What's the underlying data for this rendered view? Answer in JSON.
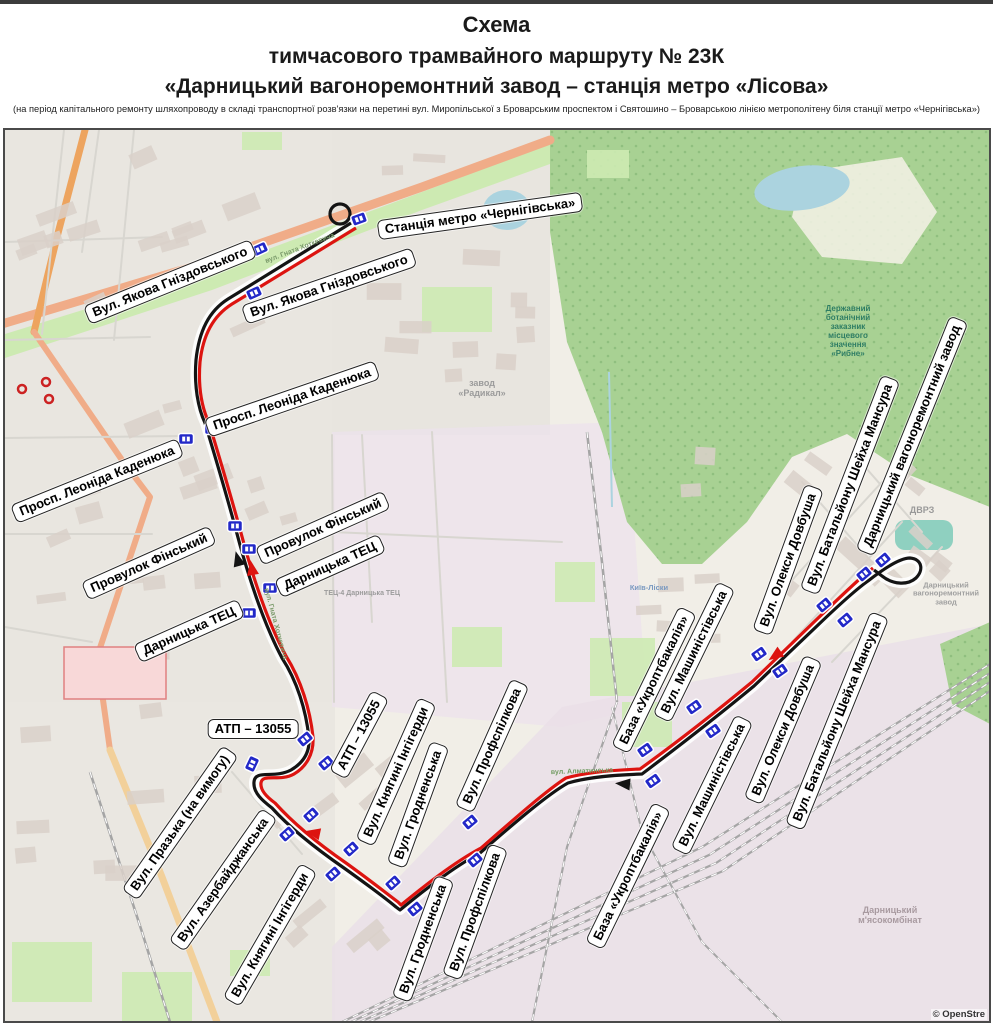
{
  "header": {
    "title1": "Схема",
    "title2": "тимчасового трамвайного маршруту  № 23К",
    "title3": "«Дарницький вагоноремонтний завод – станція метро «Лісова»",
    "note": "(на період капітального ремонту шляхопроводу в складі транспортної розв'язки на перетині вул. Миропільської з Броварським проспектом і Святошино – Броварською лінією метрополітену біля станції метро «Чернігівська»)"
  },
  "map": {
    "colors": {
      "map_bg": "#f1eee7",
      "urban": "#e9e6e0",
      "industrial": "#ece2ec",
      "forest": "#a8d193",
      "forest_dot": "#8fbf7f",
      "park": "#cdeab2",
      "water": "#abd3df",
      "pond_teal": "#8fd0c0",
      "road_salmon": "#f0ac88",
      "road_orange": "#eda45f",
      "road_yellow": "#f2d09a",
      "street": "#d8d6d0",
      "rail": "#a5a5a5",
      "building": "#d9d0c9",
      "route_red": "#dd1410",
      "route_black": "#141414",
      "stop_blue": "#2228c8",
      "stop_border": "#ffffff",
      "poi_red": "#cc2222",
      "hospital_fill": "#f8d8d8",
      "hospital_stroke": "#e08080"
    },
    "route": {
      "metro_loop": {
        "cx": 338,
        "cy": 212,
        "r": 10
      },
      "black_path": "M 349,221 C 320,239 272,269 226,297 C 207,309 197,329 194,358 C 192,384 196,406 203,421 C 212,451 224,490 238,543 C 248,579 262,622 280,656 C 295,679 304,708 307,736 C 308,751 301,761 289,768 C 272,777 253,767 252,780 C 251,791 261,799 270,806 C 288,826 316,848 342,866 C 363,881 382,895 394,905 L 398,908 C 420,890 450,866 478,851 C 510,823 546,792 566,781 C 586,775 612,773 640,772 C 665,753 700,727 752,684 L 815,624 C 840,600 856,586 866,579 C 880,568 897,556 908,556 C 920,557 922,568 914,576 C 905,584 890,582 880,574 L 872,568",
      "red_path": "M 354,226 C 324,244 276,274 230,302 C 211,314 201,333 198,360 C 196,385 200,406 207,421 C 216,451 228,490 242,542 C 252,578 266,621 284,654 C 299,678 308,707 311,735 C 312,752 304,765 292,772 C 278,780 260,771 259,781 C 258,789 266,796 273,801 C 291,821 318,843 344,861 C 365,876 384,891 396,900 L 399,903 C 421,885 451,861 479,846 C 511,818 545,788 564,776 C 585,770 612,768 638,767 C 663,749 698,723 750,680 L 812,620 C 837,596 852,582 861,574 L 871,566"
    },
    "arrows": [
      {
        "x": 236,
        "y": 558,
        "angle": -105,
        "color": "black"
      },
      {
        "x": 250,
        "y": 567,
        "angle": -100,
        "color": "red"
      },
      {
        "x": 312,
        "y": 831,
        "angle": 192,
        "color": "red"
      },
      {
        "x": 622,
        "y": 782,
        "angle": 185,
        "color": "black"
      },
      {
        "x": 774,
        "y": 653,
        "angle": 145,
        "color": "red"
      }
    ],
    "stop_icons": [
      {
        "x": 357,
        "y": 217,
        "r": -20
      },
      {
        "x": 258,
        "y": 247,
        "r": -25
      },
      {
        "x": 252,
        "y": 291,
        "r": -25
      },
      {
        "x": 210,
        "y": 427,
        "r": 0
      },
      {
        "x": 184,
        "y": 437,
        "r": 0
      },
      {
        "x": 233,
        "y": 524,
        "r": 0
      },
      {
        "x": 247,
        "y": 547,
        "r": 0
      },
      {
        "x": 268,
        "y": 586,
        "r": 0
      },
      {
        "x": 247,
        "y": 611,
        "r": 0
      },
      {
        "x": 303,
        "y": 737,
        "r": -40
      },
      {
        "x": 324,
        "y": 761,
        "r": -40
      },
      {
        "x": 250,
        "y": 762,
        "r": -65
      },
      {
        "x": 285,
        "y": 832,
        "r": -42
      },
      {
        "x": 309,
        "y": 813,
        "r": -42
      },
      {
        "x": 331,
        "y": 872,
        "r": -42
      },
      {
        "x": 349,
        "y": 847,
        "r": -42
      },
      {
        "x": 391,
        "y": 881,
        "r": -42
      },
      {
        "x": 413,
        "y": 907,
        "r": -40
      },
      {
        "x": 468,
        "y": 820,
        "r": -40
      },
      {
        "x": 473,
        "y": 858,
        "r": -40
      },
      {
        "x": 643,
        "y": 748,
        "r": -35
      },
      {
        "x": 651,
        "y": 779,
        "r": -35
      },
      {
        "x": 692,
        "y": 705,
        "r": -35
      },
      {
        "x": 711,
        "y": 729,
        "r": -35
      },
      {
        "x": 757,
        "y": 652,
        "r": -35
      },
      {
        "x": 778,
        "y": 669,
        "r": -35
      },
      {
        "x": 822,
        "y": 603,
        "r": -40
      },
      {
        "x": 843,
        "y": 618,
        "r": -40
      },
      {
        "x": 862,
        "y": 572,
        "r": -40
      },
      {
        "x": 881,
        "y": 558,
        "r": -40
      }
    ],
    "stop_labels": [
      {
        "t": "Станція метро «Чернігівська»",
        "x": 478,
        "y": 214,
        "r": -8
      },
      {
        "t": "Вул. Якова Гніздовського",
        "x": 168,
        "y": 280,
        "r": -22
      },
      {
        "t": "Вул. Якова Гніздовського",
        "x": 327,
        "y": 284,
        "r": -19
      },
      {
        "t": "Просп. Леоніда Каденюка",
        "x": 95,
        "y": 479,
        "r": -22
      },
      {
        "t": "Просп. Леоніда Каденюка",
        "x": 290,
        "y": 397,
        "r": -19
      },
      {
        "t": "Провулок Фінський",
        "x": 147,
        "y": 561,
        "r": -24
      },
      {
        "t": "Провулок Фінський",
        "x": 321,
        "y": 526,
        "r": -24
      },
      {
        "t": "Дарницька ТЕЦ",
        "x": 187,
        "y": 629,
        "r": -24
      },
      {
        "t": "Дарницька ТЕЦ",
        "x": 328,
        "y": 564,
        "r": -24
      },
      {
        "t": "АТП – 13055",
        "x": 251,
        "y": 727,
        "r": 0
      },
      {
        "t": "АТП – 13055",
        "x": 357,
        "y": 733,
        "r": -62
      },
      {
        "t": "Вул. Празька (на вимогу)",
        "x": 178,
        "y": 821,
        "r": -55
      },
      {
        "t": "Вул. Азербайджанська",
        "x": 221,
        "y": 878,
        "r": -55
      },
      {
        "t": "Вул. Княгині Інгігерди",
        "x": 394,
        "y": 770,
        "r": -66
      },
      {
        "t": "Вул. Княгині Інгігерди",
        "x": 268,
        "y": 933,
        "r": -60
      },
      {
        "t": "Вул. Гродненська",
        "x": 416,
        "y": 803,
        "r": -70
      },
      {
        "t": "Вул. Гродненська",
        "x": 421,
        "y": 937,
        "r": -70
      },
      {
        "t": "Вул. Профспілкова",
        "x": 490,
        "y": 744,
        "r": -66
      },
      {
        "t": "Вул. Профспілкова",
        "x": 473,
        "y": 910,
        "r": -70
      },
      {
        "t": "База «Укроптбакалія»",
        "x": 652,
        "y": 678,
        "r": -64
      },
      {
        "t": "База «Укроптбакалія»",
        "x": 626,
        "y": 874,
        "r": -64
      },
      {
        "t": "Вул. Машиністівська",
        "x": 692,
        "y": 650,
        "r": -64
      },
      {
        "t": "Вул. Машиністівська",
        "x": 710,
        "y": 783,
        "r": -64
      },
      {
        "t": "Вул. Олекси Довбуша",
        "x": 786,
        "y": 558,
        "r": -70
      },
      {
        "t": "Вул. Олекси Довбуша",
        "x": 781,
        "y": 728,
        "r": -67
      },
      {
        "t": "Вул. Батальйону Шейха Мансура",
        "x": 848,
        "y": 483,
        "r": -69
      },
      {
        "t": "Вул. Батальйону Шейха Мансура",
        "x": 835,
        "y": 719,
        "r": -68
      },
      {
        "t": "Дарницький вагоноремонтний завод",
        "x": 910,
        "y": 434,
        "r": -68
      }
    ],
    "map_texts": [
      {
        "lines": [
          "завод",
          "«Радикал»"
        ],
        "x": 480,
        "y": 386,
        "size": 9,
        "color": "#9b9b9b",
        "rot": 0
      },
      {
        "lines": [
          "Державний",
          "ботанічний",
          "заказник",
          "місцевого",
          "значення",
          "«Рибне»"
        ],
        "x": 846,
        "y": 330,
        "size": 8,
        "color": "#2e7d64",
        "rot": 0
      },
      {
        "lines": [
          "ДВРЗ"
        ],
        "x": 920,
        "y": 508,
        "size": 9,
        "color": "#999999",
        "rot": 0
      },
      {
        "lines": [
          "Дарницький",
          "вагоноремонтний",
          "завод"
        ],
        "x": 944,
        "y": 592,
        "size": 7.5,
        "color": "#a0a0a0",
        "rot": 0
      },
      {
        "lines": [
          "Дарницький",
          "м'ясокомбінат"
        ],
        "x": 888,
        "y": 913,
        "size": 9,
        "color": "#a89aa0",
        "rot": 0
      },
      {
        "lines": [
          "Київ-Ліски"
        ],
        "x": 647,
        "y": 586,
        "size": 7.5,
        "color": "#7a99c0",
        "rot": 0
      },
      {
        "lines": [
          "вул. Алматинська"
        ],
        "x": 580,
        "y": 770,
        "size": 7,
        "color": "#6f9a5f",
        "rot": -2
      },
      {
        "lines": [
          "ТЕЦ-4 Дарницька ТЕЦ"
        ],
        "x": 360,
        "y": 592,
        "size": 7,
        "color": "#9b9b9b",
        "rot": 0
      },
      {
        "lines": [
          "Броварський проспект"
        ],
        "x": 150,
        "y": 293,
        "size": 7,
        "color": "#7a9a6a",
        "rot": -17
      },
      {
        "lines": [
          "вул. Гната Хоткевича"
        ],
        "x": 298,
        "y": 247,
        "size": 7,
        "color": "#7a9a6a",
        "rot": -21
      },
      {
        "lines": [
          "вул. Гната Хоткевича"
        ],
        "x": 273,
        "y": 622,
        "size": 7,
        "color": "#7a9a6a",
        "rot": 75
      }
    ],
    "poi_markers": [
      {
        "x": 20,
        "y": 387
      },
      {
        "x": 44,
        "y": 380
      },
      {
        "x": 47,
        "y": 397
      }
    ],
    "attribution": "© OpenStre"
  }
}
